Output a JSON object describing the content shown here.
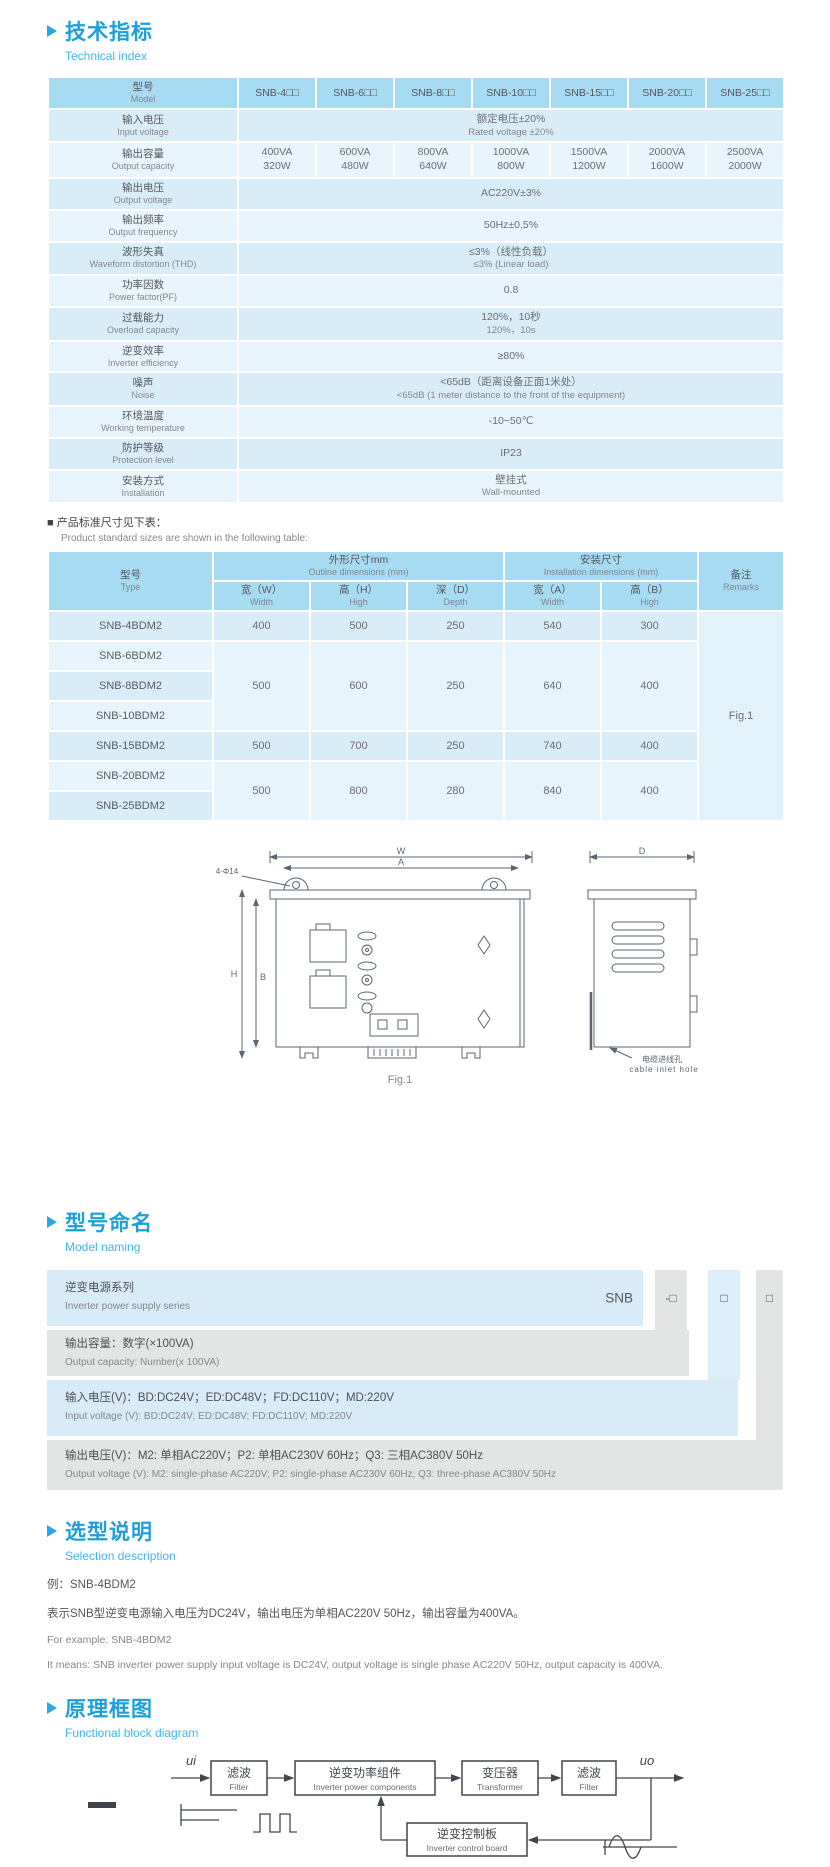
{
  "tech": {
    "title_cn": "技术指标",
    "title_en": "Technical index",
    "head": {
      "model_cn": "型号",
      "model_en": "Model"
    },
    "models": [
      "SNB-4□□",
      "SNB-6□□",
      "SNB-8□□",
      "SNB-10□□",
      "SNB-15□□",
      "SNB-20□□",
      "SNB-25□□"
    ],
    "spec": {
      "input_voltage": {
        "cn": "输入电压",
        "en": "Input voltage",
        "v1": "额定电压±20%",
        "v2": "Rated voltage ±20%"
      },
      "output_capacity": {
        "cn": "输出容量",
        "en": "Output capacity",
        "va": [
          "400VA",
          "600VA",
          "800VA",
          "1000VA",
          "1500VA",
          "2000VA",
          "2500VA"
        ],
        "w": [
          "320W",
          "480W",
          "640W",
          "800W",
          "1200W",
          "1600W",
          "2000W"
        ]
      },
      "output_voltage": {
        "cn": "输出电压",
        "en": "Output voltage",
        "v1": "AC220V±3%"
      },
      "output_frequency": {
        "cn": "输出频率",
        "en": "Output frequency",
        "v1": "50Hz±0.5%"
      },
      "waveform_distortion": {
        "cn": "波形失真",
        "en": "Waveform distortion (THD)",
        "v1": "≤3%（线性负载）",
        "v2": "≤3% (Linear load)"
      },
      "power_factor": {
        "cn": "功率因数",
        "en": "Power factor(PF)",
        "v1": "0.8"
      },
      "overload": {
        "cn": "过载能力",
        "en": "Overload capacity",
        "v1": "120%，10秒",
        "v2": "120%，10s"
      },
      "efficiency": {
        "cn": "逆变效率",
        "en": "Inverter efficiency",
        "v1": "≥80%"
      },
      "noise": {
        "cn": "噪声",
        "en": "Noise",
        "v1": "<65dB（距离设备正面1米处）",
        "v2": "<65dB (1 meter distance to the front of the equipment)"
      },
      "temperature": {
        "cn": "环境温度",
        "en": "Working temperature",
        "v1": "-10~50℃"
      },
      "protection": {
        "cn": "防护等级",
        "en": "Protection level",
        "v1": "IP23"
      },
      "installation": {
        "cn": "安装方式",
        "en": "Installation",
        "v1": "壁挂式",
        "v2": "Wall-mounted"
      }
    }
  },
  "dims": {
    "note_cn": "■ 产品标准尺寸见下表：",
    "note_en": "Product standard sizes are shown in the following table:",
    "head": {
      "type_cn": "型号",
      "type_en": "Type",
      "outline_cn": "外形尺寸mm",
      "outline_en": "Outline dimensions (mm)",
      "install_cn": "安装尺寸",
      "install_en": "Installation dimensions (mm)",
      "remarks_cn": "备注",
      "remarks_en": "Remarks",
      "w_cn": "宽（W）",
      "w_en": "Width",
      "h_cn": "高（H）",
      "h_en": "High",
      "d_cn": "深（D）",
      "d_en": "Depth",
      "a_cn": "宽（A）",
      "a_en": "Width",
      "b_cn": "高（B）",
      "b_en": "High"
    },
    "types": [
      "SNB-4BDM2",
      "SNB-6BDM2",
      "SNB-8BDM2",
      "SNB-10BDM2",
      "SNB-15BDM2",
      "SNB-20BDM2",
      "SNB-25BDM2"
    ],
    "values": [
      {
        "w": "400",
        "h": "500",
        "d": "250",
        "a": "540",
        "b": "300"
      },
      {
        "w": "500",
        "h": "600",
        "d": "250",
        "a": "640",
        "b": "400"
      },
      {
        "w": "500",
        "h": "700",
        "d": "250",
        "a": "740",
        "b": "400"
      },
      {
        "w": "500",
        "h": "800",
        "d": "280",
        "a": "840",
        "b": "400"
      }
    ],
    "remark": "Fig.1"
  },
  "figure": {
    "dim_w": "W",
    "dim_a": "A",
    "dim_d": "D",
    "dim_h": "H",
    "dim_b": "B",
    "holes": "4-Φ14",
    "inlet_cn": "电缆进线孔",
    "inlet_en": "cable inlet hole",
    "caption": "Fig.1"
  },
  "naming": {
    "title_cn": "型号命名",
    "title_en": "Model naming",
    "series_code": "SNB",
    "box1": "-□",
    "box2": "□",
    "box3": "□",
    "rows": [
      {
        "cn": "逆变电源系列",
        "en": "Inverter power supply series"
      },
      {
        "cn": "输出容量：数字(×100VA)",
        "en": "Output capacity: Number(x 100VA)"
      },
      {
        "cn": "输入电压(V)：BD:DC24V；ED:DC48V；FD:DC110V；MD:220V",
        "en": "Input voltage (V): BD:DC24V;  ED:DC48V;  FD:DC110V; MD:220V"
      },
      {
        "cn": "输出电压(V)：M2: 单相AC220V；P2: 单相AC230V 60Hz；Q3: 三相AC380V 50Hz",
        "en": "Output voltage (V):  M2: single-phase AC220V;  P2: single-phase AC230V 60Hz;  Q3: three-phase AC380V 50Hz"
      }
    ]
  },
  "selection": {
    "title_cn": "选型说明",
    "title_en": "Selection description",
    "line1": "例：SNB-4BDM2",
    "line2": "表示SNB型逆变电源输入电压为DC24V，输出电压为单相AC220V 50Hz，输出容量为400VA。",
    "line3": "For example: SNB-4BDM2",
    "line4": "It means: SNB inverter power supply input voltage is DC24V, output voltage is single phase AC220V 50Hz, output capacity is 400VA."
  },
  "diagram": {
    "title_cn": "原理框图",
    "title_en": "Functional block diagram",
    "ui": "ui",
    "uo": "uo",
    "filter1_cn": "滤波",
    "filter1_en": "Filter",
    "inverter_cn": "逆变功率组件",
    "inverter_en": "Inverter power components",
    "transformer_cn": "变压器",
    "transformer_en": "Transformer",
    "filter2_cn": "滤波",
    "filter2_en": "Filter",
    "control_cn": "逆变控制板",
    "control_en": "Inverter control board"
  },
  "colors": {
    "accent": "#29a8e0",
    "table_header": "#a6dbf2",
    "row_blue_dark": "#d9edf8",
    "row_blue_light": "#e9f5fc",
    "gray_band": "#e3e4e4"
  }
}
